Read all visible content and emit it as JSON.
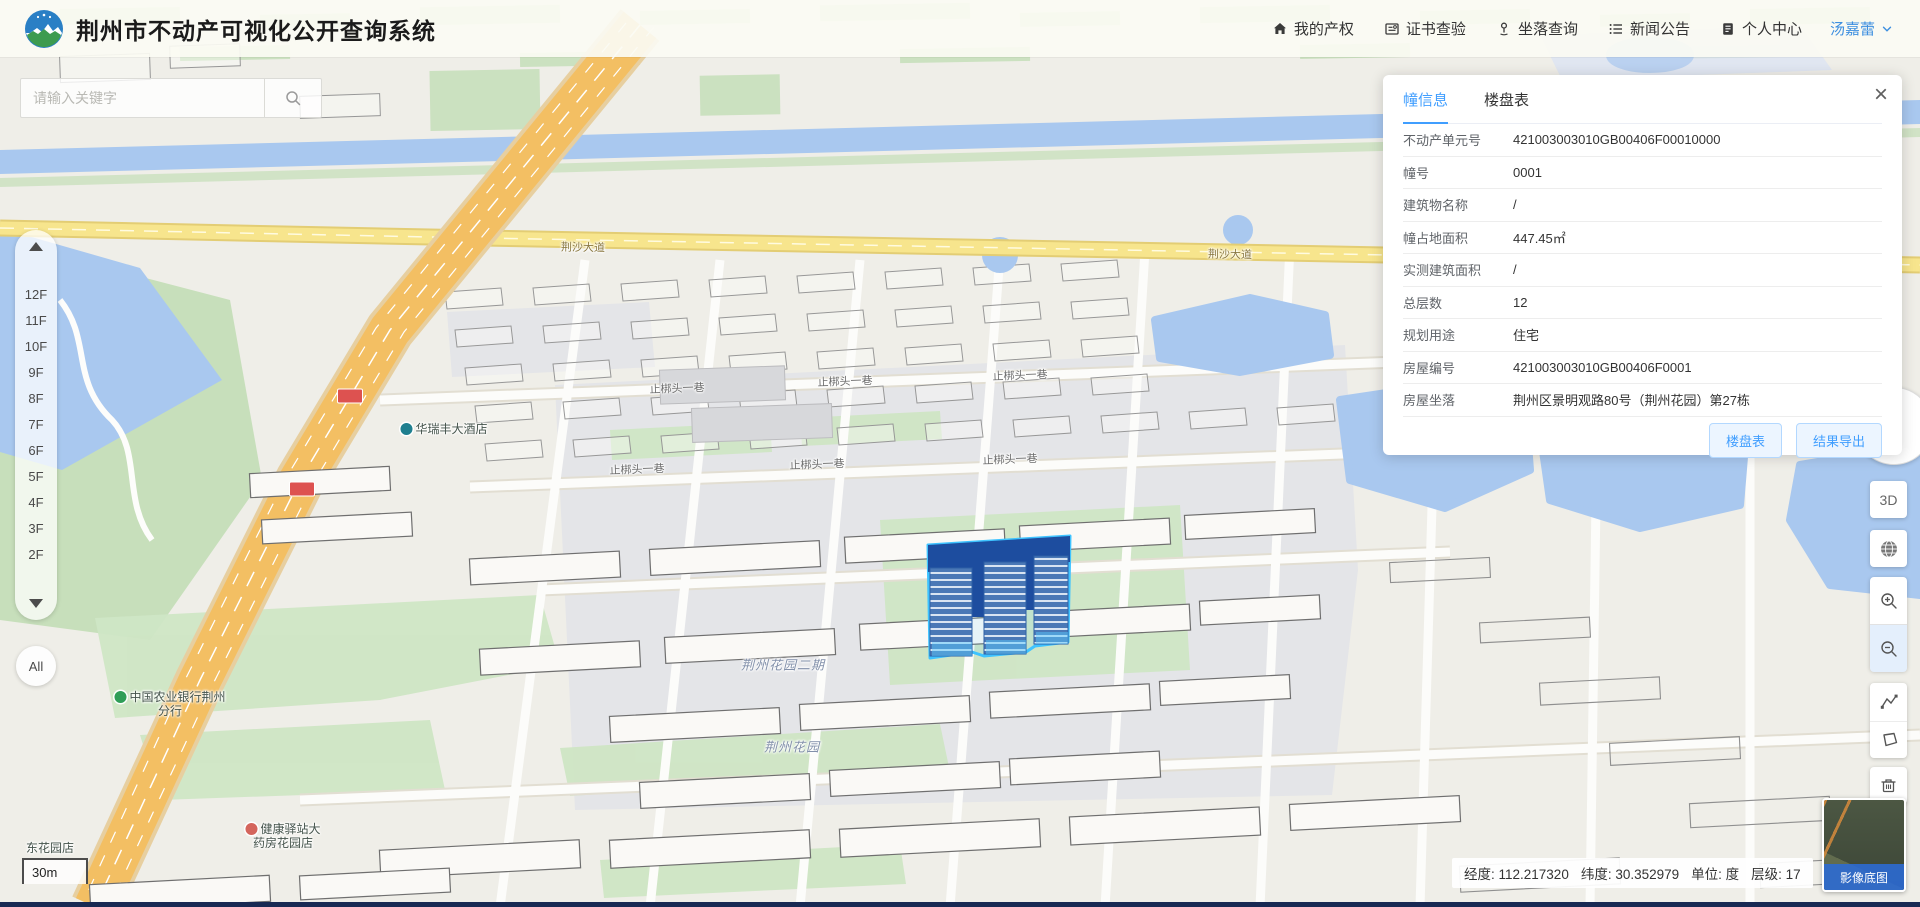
{
  "app": {
    "title": "荆州市不动产可视化公开查询系统"
  },
  "header": {
    "nav": [
      {
        "id": "my-property",
        "icon": "home-icon",
        "label": "我的产权"
      },
      {
        "id": "cert-check",
        "icon": "certificate-icon",
        "label": "证书查验"
      },
      {
        "id": "location-query",
        "icon": "location-icon",
        "label": "坐落查询"
      },
      {
        "id": "news",
        "icon": "news-icon",
        "label": "新闻公告"
      },
      {
        "id": "personal-center",
        "icon": "user-doc-icon",
        "label": "个人中心"
      }
    ],
    "user": {
      "name": "汤嘉蕾"
    }
  },
  "search": {
    "placeholder": "请输入关键字"
  },
  "floor_selector": {
    "floors": [
      "12F",
      "11F",
      "10F",
      "9F",
      "8F",
      "7F",
      "6F",
      "5F",
      "4F",
      "3F",
      "2F"
    ],
    "all_label": "All"
  },
  "panel": {
    "tabs": [
      {
        "label": "幢信息",
        "active": true
      },
      {
        "label": "楼盘表",
        "active": false
      }
    ],
    "rows": [
      {
        "label": "不动产单元号",
        "value": "421003003010GB00406F00010000"
      },
      {
        "label": "幢号",
        "value": "0001"
      },
      {
        "label": "建筑物名称",
        "value": "/"
      },
      {
        "label": "幢占地面积",
        "value": "447.45㎡"
      },
      {
        "label": "实测建筑面积",
        "value": "/"
      },
      {
        "label": "总层数",
        "value": "12"
      },
      {
        "label": "规划用途",
        "value": "住宅"
      },
      {
        "label": "房屋编号",
        "value": "421003003010GB00406F0001"
      },
      {
        "label": "房屋坐落",
        "value": "荆州区景明观路80号（荆州花园）第27栋"
      }
    ],
    "buttons": [
      {
        "id": "floor-table",
        "label": "楼盘表"
      },
      {
        "id": "export-result",
        "label": "结果导出"
      }
    ]
  },
  "controls": {
    "threed_label": "3D"
  },
  "statusbar": {
    "parts": [
      {
        "label": "经度",
        "value": "112.217320"
      },
      {
        "label": "纬度",
        "value": "30.352979"
      },
      {
        "label": "单位",
        "value": "度"
      },
      {
        "label": "层级",
        "value": "17"
      }
    ]
  },
  "basemap": {
    "label": "影像底图"
  },
  "scalebar": {
    "label": "30m"
  },
  "map": {
    "labels": [
      {
        "type": "road",
        "x": 583,
        "y": 247,
        "lines": [
          "荆沙大道"
        ]
      },
      {
        "type": "road",
        "x": 1230,
        "y": 254,
        "lines": [
          "荆沙大道"
        ]
      },
      {
        "type": "road",
        "x": 1745,
        "y": 262,
        "lines": [
          "荆沙大道"
        ]
      },
      {
        "type": "street",
        "x": 677,
        "y": 388,
        "lines": [
          "止梆头一巷"
        ]
      },
      {
        "type": "street",
        "x": 845,
        "y": 381,
        "lines": [
          "止梆头一巷"
        ]
      },
      {
        "type": "street",
        "x": 1020,
        "y": 375,
        "lines": [
          "止梆头一巷"
        ]
      },
      {
        "type": "street",
        "x": 637,
        "y": 469,
        "lines": [
          "止梆头一巷"
        ]
      },
      {
        "type": "street",
        "x": 817,
        "y": 464,
        "lines": [
          "止梆头一巷"
        ]
      },
      {
        "type": "street",
        "x": 1010,
        "y": 459,
        "lines": [
          "止梆头一巷"
        ]
      },
      {
        "type": "area",
        "x": 783,
        "y": 664,
        "lines": [
          "荆州花园二期"
        ]
      },
      {
        "type": "area",
        "x": 792,
        "y": 746,
        "lines": [
          "荆州花园"
        ]
      },
      {
        "type": "poi",
        "x": 170,
        "y": 704,
        "lines": [
          "中国农业银行荆州",
          "分行"
        ],
        "icon_color": "#2f9e57"
      },
      {
        "type": "poi",
        "x": 283,
        "y": 836,
        "lines": [
          "健康驿站大",
          "药房花园店"
        ],
        "icon_color": "#d4655c"
      },
      {
        "type": "poi",
        "x": 444,
        "y": 429,
        "lines": [
          "华瑞丰大酒店"
        ],
        "icon_color": "#1f7f8f"
      },
      {
        "type": "poi",
        "x": 50,
        "y": 848,
        "lines": [
          "东花园店"
        ]
      }
    ],
    "road_badges": [
      {
        "x": 350,
        "y": 396
      },
      {
        "x": 302,
        "y": 489
      }
    ]
  },
  "colors": {
    "accent": "#409eff",
    "water": "#a9c8ef",
    "road_yellow": "#f7e58d",
    "road_orange": "#f3bf63",
    "selected_building_roof": "#1d4d9f",
    "selected_building_body": "#4a78b6",
    "selected_building_outline": "#3ec3ff",
    "basemap_label_bg": "#2b6bd6"
  }
}
